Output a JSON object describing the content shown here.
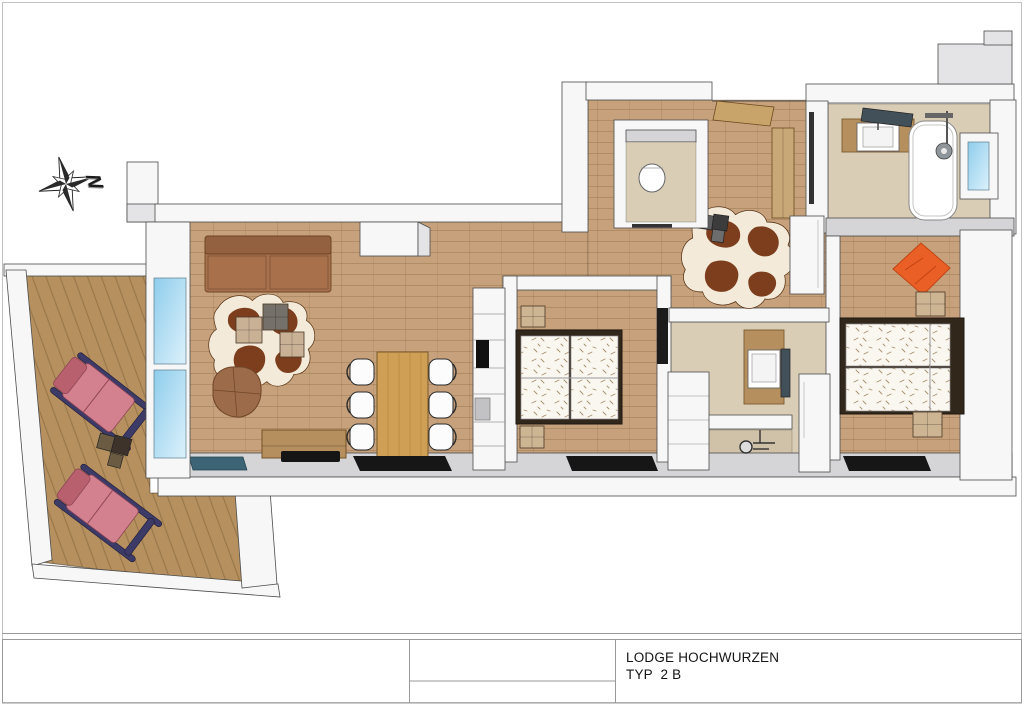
{
  "title_block": {
    "project": "LODGE HOCHWURZEN",
    "type": "TYP  2 B"
  },
  "compass": {
    "label": "N"
  },
  "palette": {
    "text": "#141414",
    "line": "#9a9a9a",
    "page_border": "#c2c2c2",
    "outline": "#4c4c4c",
    "wall": "#f7f7f8",
    "wall_top": "#e4e4e6",
    "wall_gray": "#d5d5d7",
    "tile": "#d9cdb6",
    "tile_dark": "#cfc2a8",
    "wood": "#c6a17b",
    "deck": "#b6915f",
    "sofa": "#a9714b",
    "sofa_back": "#936040",
    "leather": "#9c6b4a",
    "hide": "#7c3e1d",
    "hide_base": "#f3ead9",
    "cushion_beige": "#c9b196",
    "cushion_gray": "#75716a",
    "table_wood": "#cf9f55",
    "table_grain": "#b5873f",
    "counter": "#b68f5e",
    "cooktop": "#151515",
    "chair": "#fcfcfc",
    "bed_frame": "#32271b",
    "mattress": "#faf7f1",
    "speckle": "#a8906c",
    "nightstand": "#cdb493",
    "lounger": "#d4818f",
    "lounger_dark": "#b9606f",
    "lounger_frame": "#3c3a67",
    "orange": "#e95f26",
    "orange_dark": "#c24413",
    "glass_light": "#dcf1fb",
    "glass_dark": "#8fcdec",
    "glass_door": "#3c6474",
    "window_dark": "#161616",
    "fixture": "#8f969b",
    "mirror": "#42505a",
    "wardrobe_tan": "#c9a877",
    "door_tan": "#c8a36a"
  }
}
